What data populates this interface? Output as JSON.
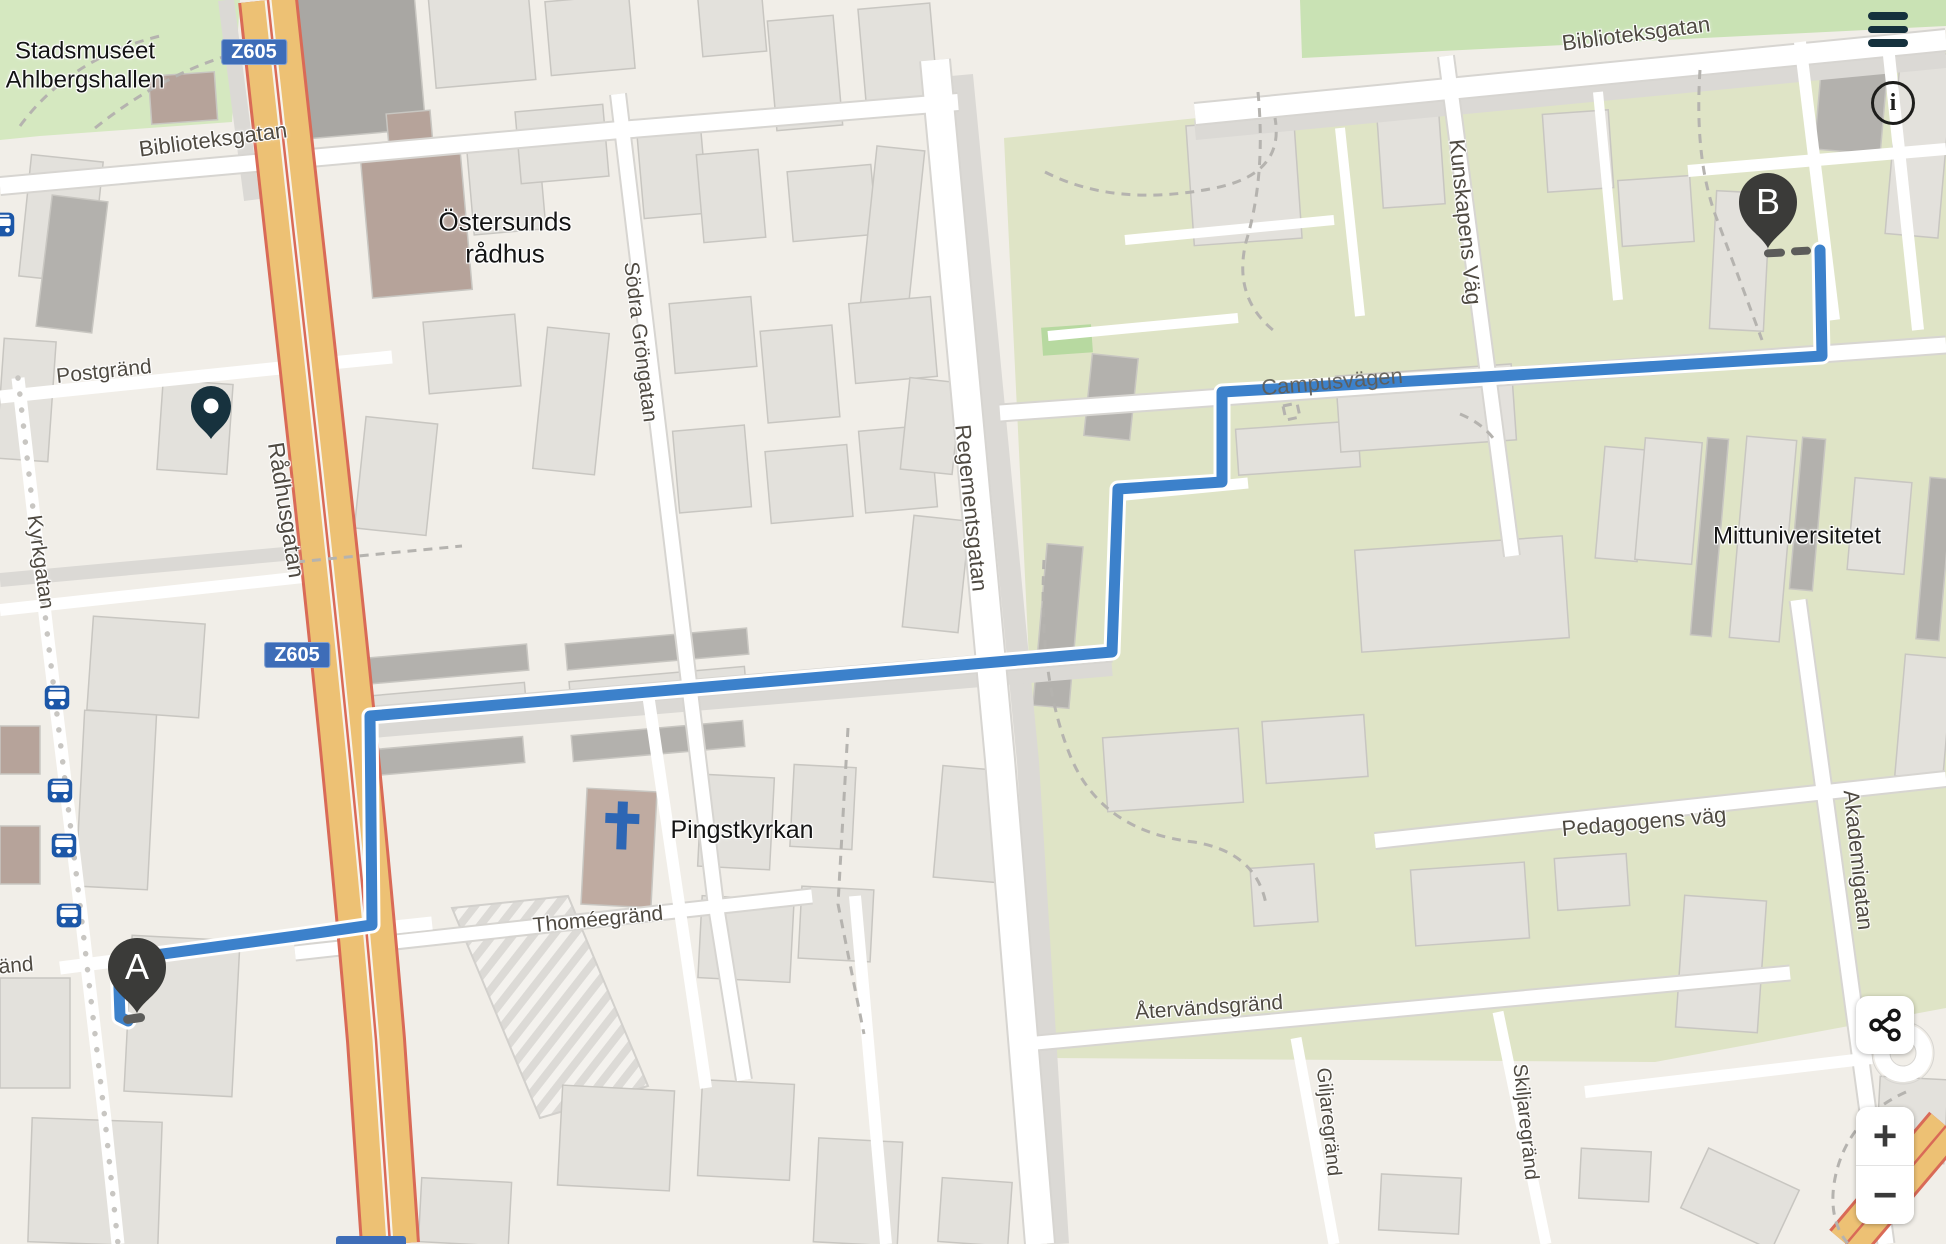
{
  "app": {
    "description": "route planner map view, Östersund Sweden"
  },
  "markers": {
    "start": "A",
    "end": "B"
  },
  "shields": {
    "s1": "Z605",
    "s2": "Z605"
  },
  "controls": {
    "zoom_in": "+",
    "zoom_out": "−",
    "info": "i"
  },
  "places": {
    "stadsmuseet_line1": "Stadsmuséet",
    "stadsmuseet_line2": "Ahlbergshallen",
    "radhus_line1": "Östersunds",
    "radhus_line2": "rådhus",
    "pingstkyrkan": "Pingstkyrkan",
    "mittuniversitetet": "Mittuniversitetet"
  },
  "streets": {
    "biblioteksgatan_w": "Biblioteksgatan",
    "biblioteksgatan_e": "Biblioteksgatan",
    "postgrand": "Postgränd",
    "kyrkgatan": "Kyrkgatan",
    "radhusgatan": "Rådhusgatan",
    "sodra_grongatan": "Södra Gröngatan",
    "regementsgatan": "Regementsgatan",
    "kunskapens_vag": "Kunskapens Väg",
    "campusvagen": "Campusvägen",
    "pedagogens_vag": "Pedagogens väg",
    "akademigatan": "Akademigatan",
    "thomeegrand": "Thoméegränd",
    "atervandsgrand": "Återvändsgränd",
    "giljaregrand": "Giljaregränd",
    "skiljaregrand": "Skiljaregränd",
    "grand_partial": "änd"
  },
  "colors": {
    "route_blue": "#3c81cb",
    "shield_bg": "#3e6db8",
    "bus_icon_blue": "#1c57a8",
    "marker_dark": "#3b3b39",
    "poi_pin_teal": "#17323e",
    "main_road_orange": "#edc174",
    "park_green": "#d5e8c0",
    "campus_green": "#dfe4c6"
  }
}
